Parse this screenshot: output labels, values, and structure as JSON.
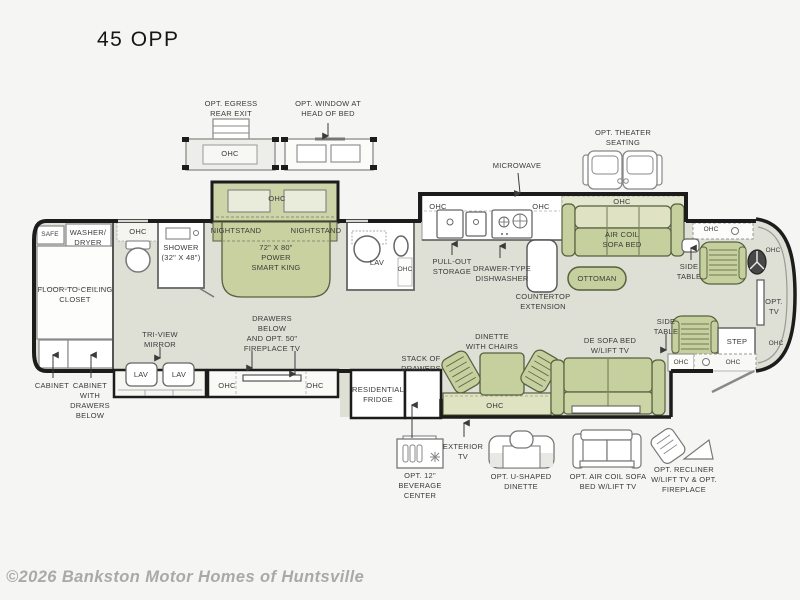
{
  "title": "45 OPP",
  "watermark": "©2026 Bankston Motor Homes of Huntsville",
  "colors": {
    "furniture_green": "#c6cf9e",
    "furniture_light": "#dfe3c4",
    "floor": "#dedfd5",
    "wall": "#1c1c1c",
    "text": "#3b3b3b",
    "watermark": "#a9a9a9"
  },
  "plan": {
    "options_top": {
      "egress": "OPT. EGRESS\nREAR EXIT",
      "egress_ohc": "OHC",
      "window": "OPT. WINDOW AT\nHEAD OF BED",
      "theater": "OPT. THEATER\nSEATING",
      "microwave": "MICROWAVE"
    },
    "bedroom": {
      "slide_ohc": "OHC",
      "nightstand_left": "NIGHTSTAND",
      "nightstand_right": "NIGHTSTAND",
      "bed": "72\" X 80\"\nPOWER\nSMART KING"
    },
    "master_bath": {
      "safe": "SAFE",
      "washer_dryer": "WASHER/\nDRYER",
      "ohc": "OHC",
      "shower": "SHOWER\n(32\" X 48\")",
      "closet": "FLOOR-TO-CEILING\nCLOSET",
      "tri_view_mirror": "TRI-VIEW\nMIRROR",
      "lav_left": "LAV",
      "lav_right": "LAV",
      "cabinet": "CABINET",
      "cabinet_drawers": "CABINET\nWITH\nDRAWERS\nBELOW"
    },
    "mid_bath": {
      "lav": "LAV",
      "ohc": "OHC"
    },
    "tv_wall": {
      "drawers_fireplace": "DRAWERS\nBELOW\nAND OPT. 50\"\nFIREPLACE TV",
      "ohc_left": "OHC",
      "ohc_right": "OHC"
    },
    "kitchen": {
      "ohc_left": "OHC",
      "ohc_right": "OHC",
      "pull_out_storage": "PULL-OUT\nSTORAGE",
      "dishwasher": "DRAWER-TYPE\nDISHWASHER",
      "countertop_extension": "COUNTERTOP\nEXTENSION",
      "fridge": "RESIDENTIAL\nFRIDGE",
      "stack_of_drawers": "STACK OF\nDRAWERS"
    },
    "living": {
      "sofa_ohc": "OHC",
      "air_coil_sofa": "AIR COIL\nSOFA BED",
      "ottoman": "OTTOMAN",
      "dinette": "DINETTE\nWITH CHAIRS",
      "dinette_ohc": "OHC",
      "de_sofa": "DE SOFA BED\nW/LIFT TV"
    },
    "front": {
      "side_table_upper": "SIDE\nTABLE",
      "side_table_lower": "SIDE\nTABLE",
      "cab_ohc": "OHC",
      "wall_ohc_top": "OHC",
      "opt_tv": "OPT. TV",
      "step": "STEP",
      "side_table_ohc": "OHC",
      "entry_ohc": "OHC",
      "wall_ohc_bottom": "OHC"
    },
    "options_bottom": {
      "beverage_center": "OPT. 12\"\nBEVERAGE\nCENTER",
      "exterior_tv": "EXTERIOR\nTV",
      "u_dinette": "OPT. U-SHAPED\nDINETTE",
      "air_coil_sofa_bed": "OPT. AIR COIL SOFA\nBED W/LIFT TV",
      "recliner": "OPT. RECLINER\nW/LIFT TV & OPT.\nFIREPLACE"
    }
  }
}
